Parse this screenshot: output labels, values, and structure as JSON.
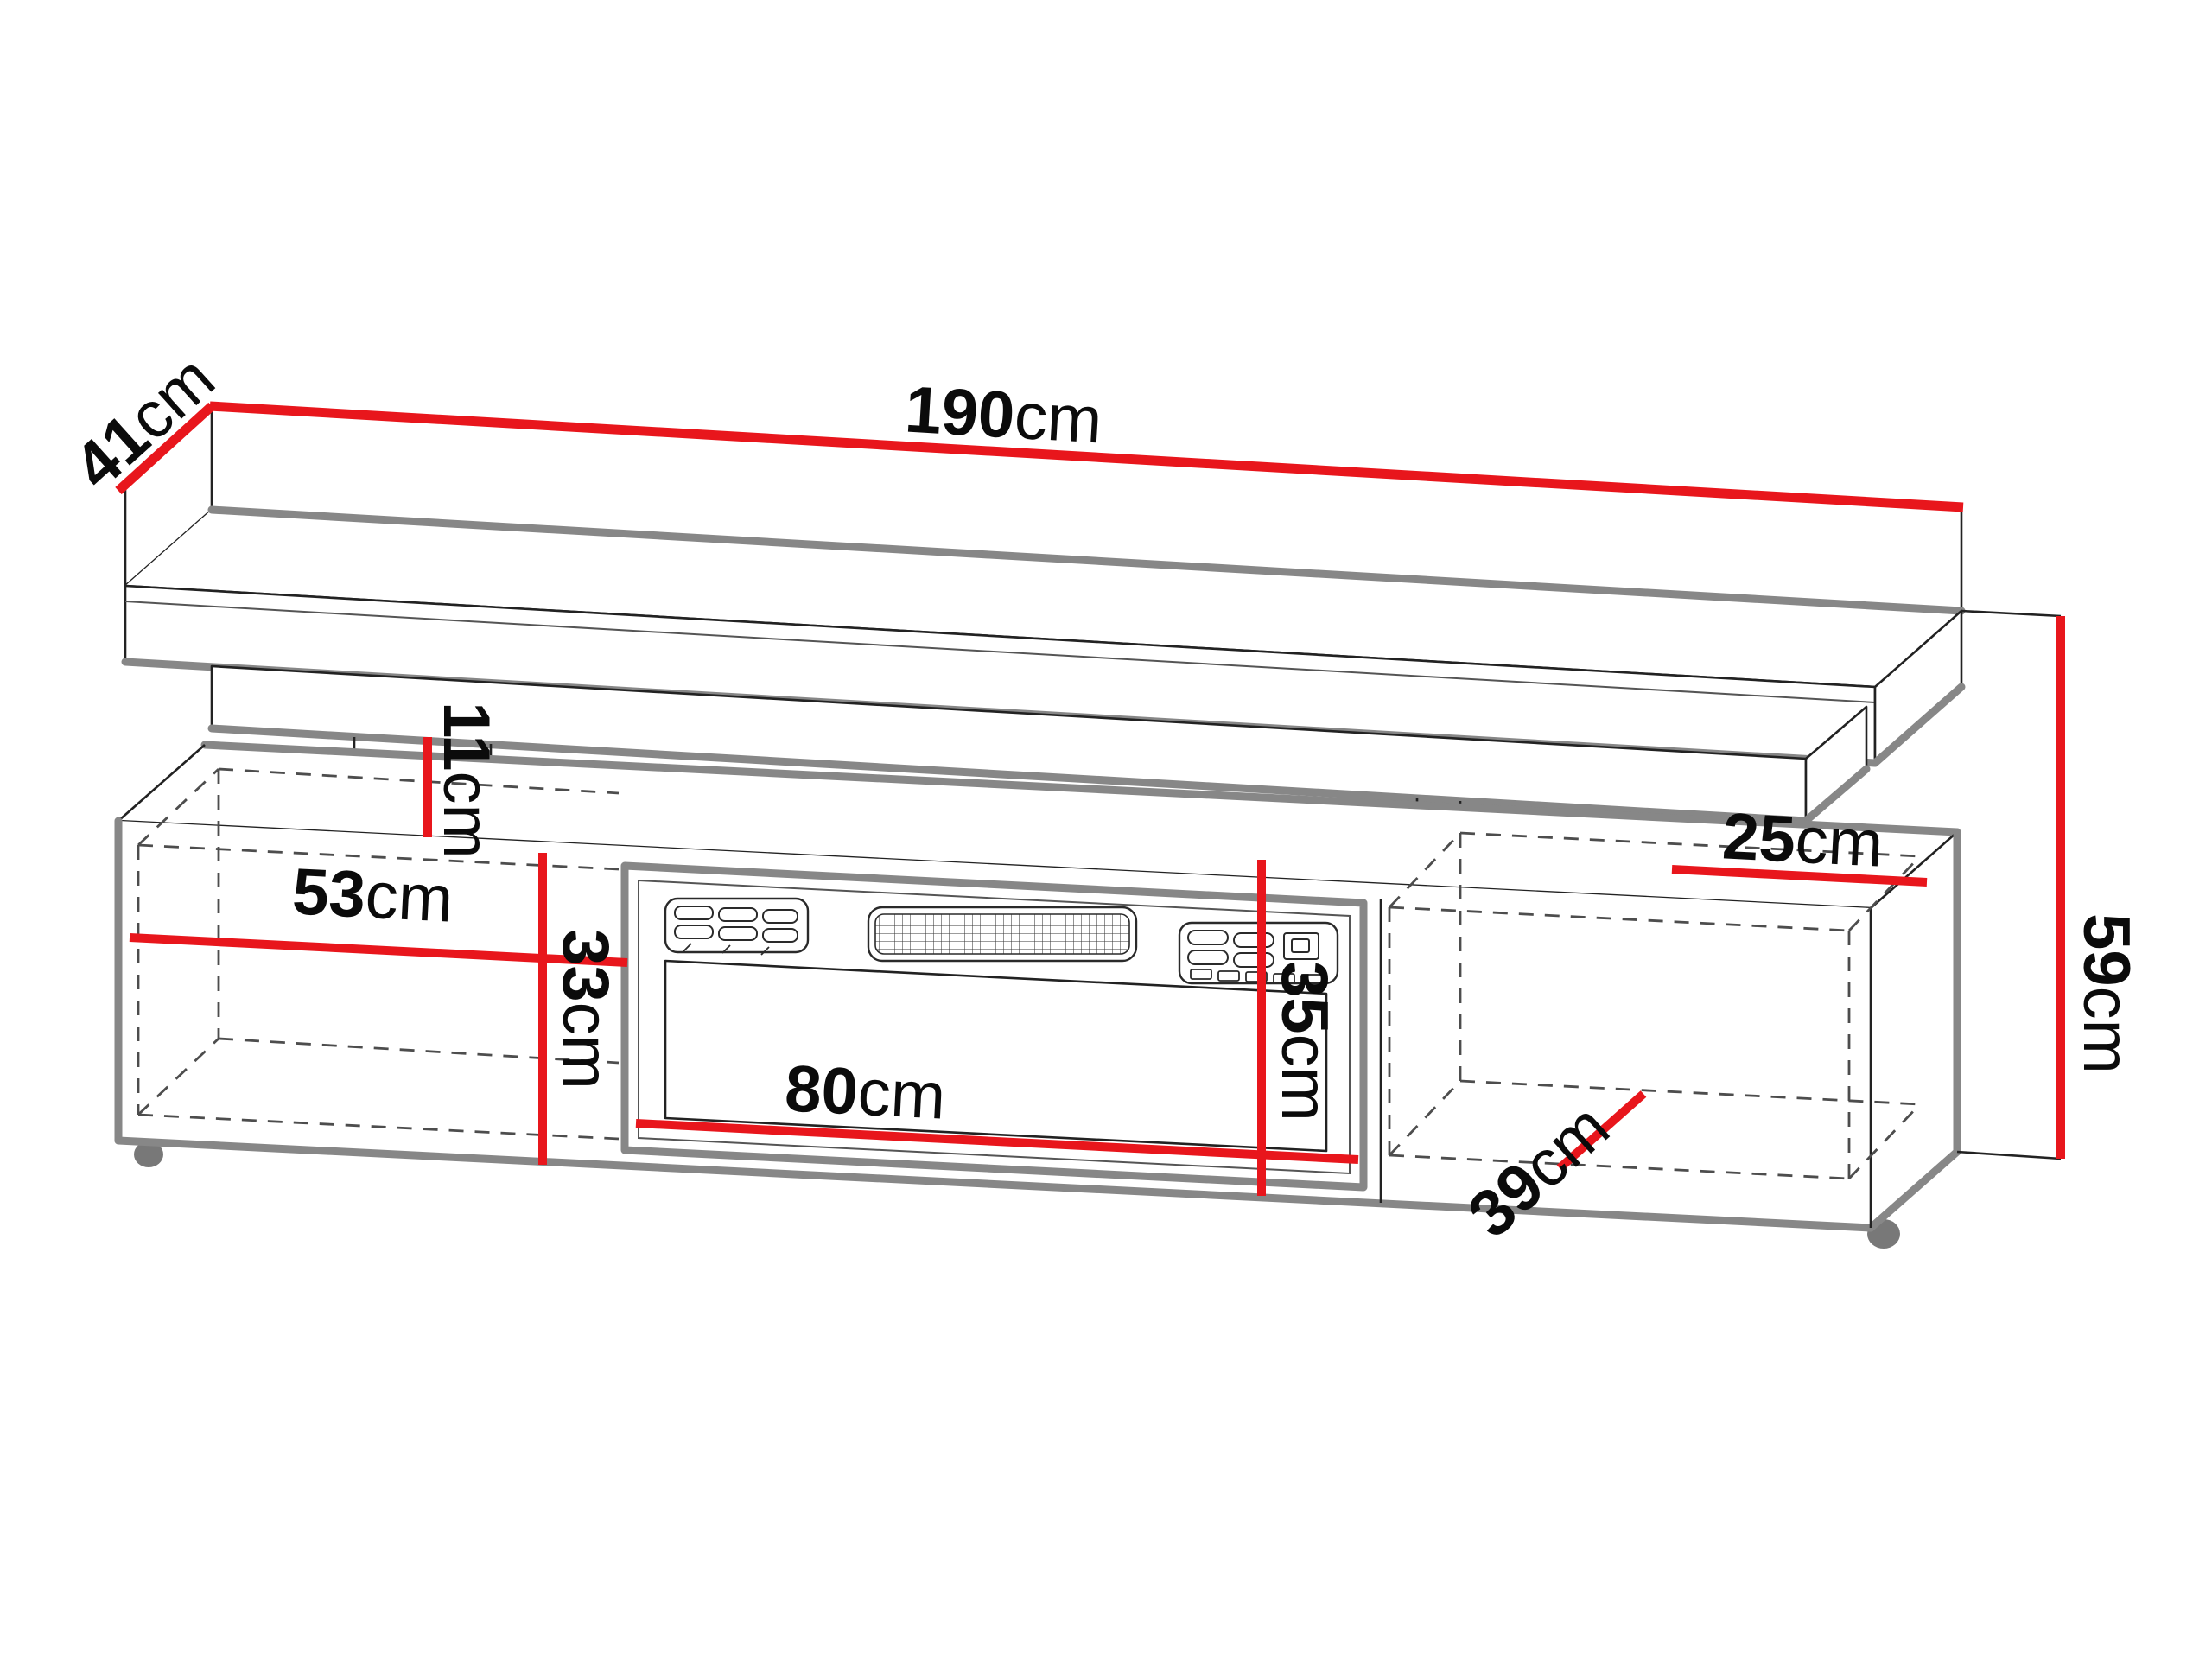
{
  "diagram": {
    "type": "furniture-dimension-drawing",
    "subject": "TV stand with electric fireplace and floating wall shelf",
    "background": "#ffffff",
    "colors": {
      "dimension_line": "#e8161c",
      "edge_thick": "#878787",
      "edge_thin": "#222222",
      "hidden_edge": "#4d4d4d",
      "foot": "#787878"
    },
    "dimensions": {
      "total_width": {
        "value": "190",
        "unit": "cm"
      },
      "shelf_depth": {
        "value": "41",
        "unit": "cm"
      },
      "total_height": {
        "value": "59",
        "unit": "cm"
      },
      "shelf_to_cabinet_gap": {
        "value": "11",
        "unit": "cm"
      },
      "left_compartment_width": {
        "value": "53",
        "unit": "cm"
      },
      "left_compartment_height": {
        "value": "33",
        "unit": "cm"
      },
      "fireplace_width": {
        "value": "80",
        "unit": "cm"
      },
      "fireplace_height": {
        "value": "35",
        "unit": "cm"
      },
      "right_top_depth": {
        "value": "25",
        "unit": "cm"
      },
      "right_compartment_depth": {
        "value": "39",
        "unit": "cm"
      }
    }
  }
}
